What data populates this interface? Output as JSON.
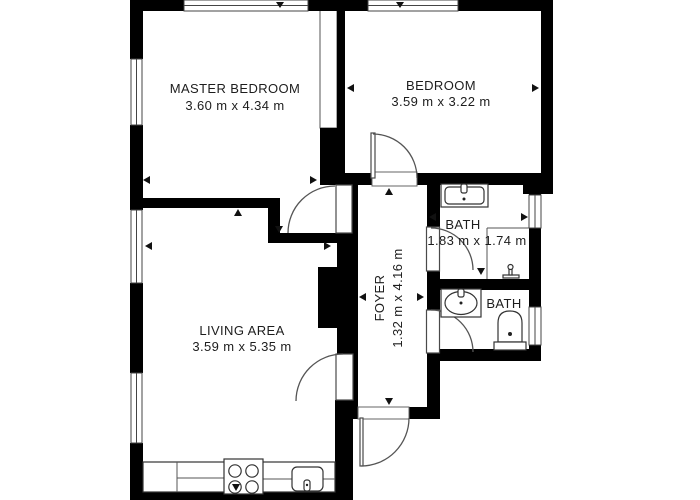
{
  "plan": {
    "type": "apartment-floor-plan",
    "units": "m",
    "colors": {
      "wall": "#000000",
      "floor": "#ffffff",
      "line": "#555555",
      "text": "#1d1d1d"
    }
  },
  "rooms": [
    {
      "id": "master-bedroom",
      "name": "MASTER BEDROOM",
      "dims": "3.60 m x 4.34 m"
    },
    {
      "id": "bedroom",
      "name": "BEDROOM",
      "dims": "3.59 m x 3.22 m"
    },
    {
      "id": "bath-top",
      "name": "BATH",
      "dims": "1.83 m x 1.74 m"
    },
    {
      "id": "foyer",
      "name": "FOYER",
      "dims": "1.32 m x 4.16 m"
    },
    {
      "id": "bath-bottom",
      "name": "BATH",
      "dims": ""
    },
    {
      "id": "living-area",
      "name": "LIVING AREA",
      "dims": "3.59 m x 5.35 m"
    }
  ],
  "fixtures": [
    "kitchen-counter",
    "stove-4-burners",
    "kitchen-sink",
    "bathroom-sink-rect",
    "bathroom-sink-oval",
    "shower",
    "toilet"
  ],
  "openings": {
    "doors": 7,
    "windows": 7
  }
}
